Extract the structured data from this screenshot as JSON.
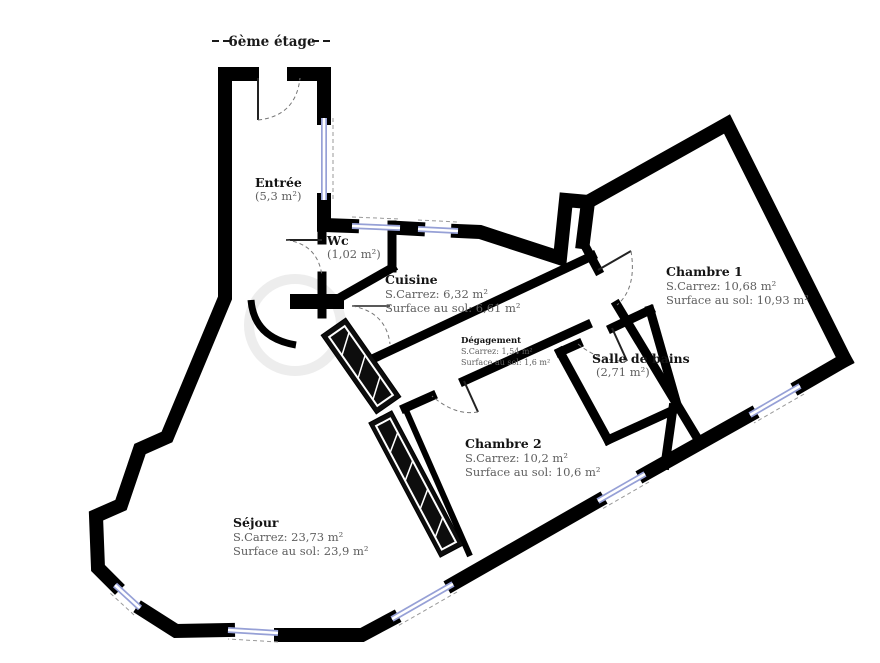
{
  "floor_label": "6ème étage",
  "rooms": [
    {
      "name": "Entrée",
      "line2": "(5,3 m²)"
    },
    {
      "name": "Wc",
      "line2": "(1,02 m²)"
    },
    {
      "name": "Cuisine",
      "line2": "S.Carrez: 6,32 m²",
      "line3": "Surface au sol: 6,61 m²"
    },
    {
      "name": "Chambre 1",
      "line2": "S.Carrez: 10,68 m²",
      "line3": "Surface au sol: 10,93 m²"
    },
    {
      "name": "Dégagement",
      "line2": "S.Carrez: 1,54 m²",
      "line3": "Surface au sol: 1,6 m²"
    },
    {
      "name": "Salle de bains",
      "line2": "(2,71 m²)"
    },
    {
      "name": "Chambre 2",
      "line2": "S.Carrez: 10,2 m²",
      "line3": "Surface au sol: 10,6 m²"
    },
    {
      "name": "Séjour",
      "line2": "S.Carrez: 23,73 m²",
      "line3": "Surface au sol: 23,9 m²"
    }
  ],
  "colors": {
    "wall": "#000000",
    "window": "#96a0d6",
    "door_dash": "#777777",
    "sub_text": "#5f5f5f"
  }
}
